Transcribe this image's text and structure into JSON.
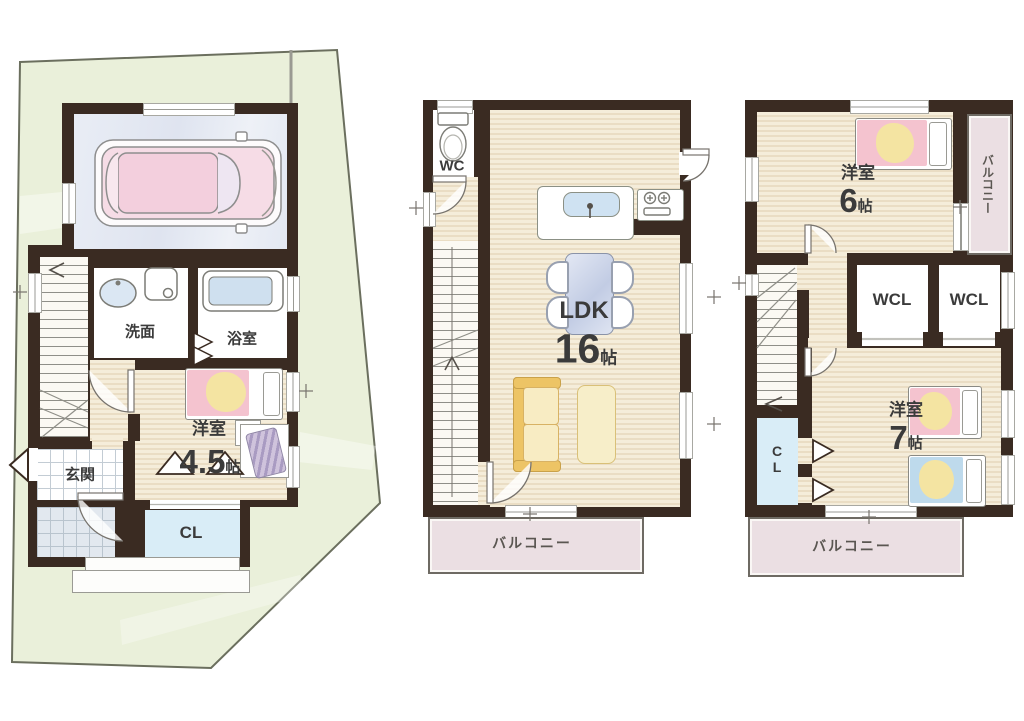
{
  "title": "3-story house floor plan",
  "floor1": {
    "washroom": "洗面",
    "bath": "浴室",
    "entrance": "玄関",
    "closet": "CL",
    "bedroom": {
      "name": "洋室",
      "size": "4.5",
      "unit": "帖"
    }
  },
  "floor2": {
    "wc": "WC",
    "ldk": {
      "name": "LDK",
      "size": "16",
      "unit": "帖"
    },
    "balcony": "バルコニー"
  },
  "floor3": {
    "bedroom6": {
      "name": "洋室",
      "size": "6",
      "unit": "帖"
    },
    "bedroom7": {
      "name": "洋室",
      "size": "7",
      "unit": "帖"
    },
    "wcl_left": "WCL",
    "wcl_right": "WCL",
    "closet": "CL",
    "balcony_side": "バルコニー",
    "balcony_bottom": "バルコニー"
  },
  "colors": {
    "wall": "#3a2b22",
    "land": "#eaf0da",
    "wood_floor": "#f5edda",
    "wood_line": "#e6d8bd",
    "garage_floor": "#e4e9f2",
    "closet_floor": "#d9edf7",
    "balcony": "#ebdfe3",
    "bed_pink": "#f4c3cf",
    "bed_blue": "#bedaec",
    "blanket_yellow": "#f4e4a2",
    "sofa": "#edc465",
    "table": "#c9d3e8",
    "label_text": "#3b3b3b"
  }
}
